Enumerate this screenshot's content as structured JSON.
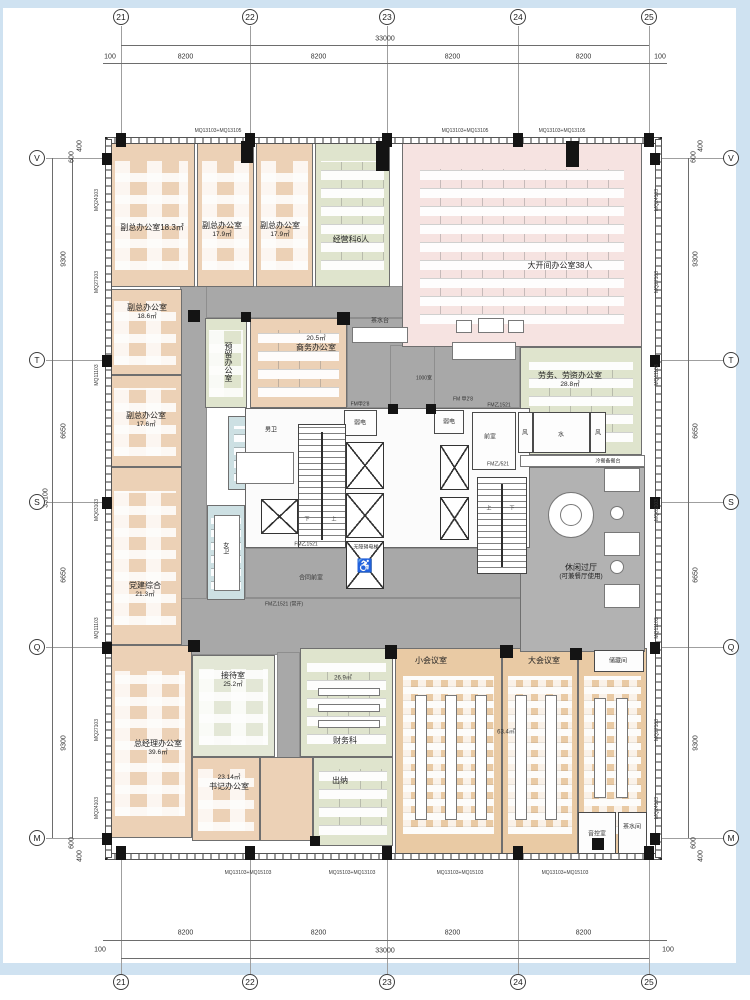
{
  "page": {
    "canvas_w": 750,
    "canvas_h": 1000
  },
  "frame": {
    "color": "#cfe2f1",
    "strips": [
      [
        0,
        0,
        750,
        8
      ],
      [
        0,
        963,
        750,
        12
      ],
      [
        736,
        8,
        14,
        955
      ],
      [
        0,
        8,
        3,
        955
      ]
    ]
  },
  "palette": {
    "peach": "#ecd1b6",
    "green": "#dfe4cd",
    "pink": "#f6e3e1",
    "tan": "#e9caa4",
    "grey": "#a8a8a8",
    "grey2": "#b2b2b2",
    "blue": "#cde0e3",
    "palegreen": "#e3e7d6",
    "wall": "#262626"
  },
  "building": {
    "x": 105,
    "y": 137,
    "w": 557,
    "h": 723
  },
  "grid": {
    "top": {
      "y_bubble": 17,
      "y_line_total": 45,
      "y_line_seg": 63,
      "total": "33000",
      "segments": [
        "8200",
        "8200",
        "8200",
        "8200"
      ],
      "offset_label": "100",
      "bubbles": [
        {
          "label": "21",
          "x": 121
        },
        {
          "label": "22",
          "x": 250
        },
        {
          "label": "23",
          "x": 387
        },
        {
          "label": "24",
          "x": 518
        },
        {
          "label": "25",
          "x": 649
        }
      ]
    },
    "bottom": {
      "y_bubble": 982,
      "y_line_total": 958,
      "y_line_seg": 940,
      "total": "33000",
      "segments": [
        "8200",
        "8200",
        "8200",
        "8200"
      ],
      "offset_label": "100"
    },
    "left": {
      "x_bubble": 37,
      "x_line_seg": 72,
      "x_line_total": 52,
      "total": "33100",
      "segments": [
        "9300",
        "6650",
        "6650",
        "9300"
      ],
      "bubbles": [
        {
          "label": "V",
          "y": 158
        },
        {
          "label": "T",
          "y": 360
        },
        {
          "label": "S",
          "y": 502
        },
        {
          "label": "Q",
          "y": 647
        },
        {
          "label": "M",
          "y": 838
        }
      ],
      "extras": [
        {
          "t": "400",
          "x": 80,
          "y": 146
        },
        {
          "t": "600",
          "x": 72,
          "y": 157
        },
        {
          "t": "600",
          "x": 72,
          "y": 843
        },
        {
          "t": "400",
          "x": 80,
          "y": 856
        }
      ]
    },
    "right": {
      "x_bubble": 731,
      "x_line_seg": 688,
      "segments": [
        "9300",
        "6650",
        "6650",
        "9300"
      ],
      "extras": [
        {
          "t": "400",
          "x": 701,
          "y": 146
        },
        {
          "t": "600",
          "x": 694,
          "y": 157
        },
        {
          "t": "600",
          "x": 694,
          "y": 843
        },
        {
          "t": "400",
          "x": 701,
          "y": 856
        }
      ]
    }
  },
  "wall_codes": {
    "left_x": 97,
    "right_x": 657,
    "side": [
      {
        "t": "MQ24103",
        "y": 200
      },
      {
        "t": "MQ27103",
        "y": 282
      },
      {
        "t": "MQ11103",
        "y": 375
      },
      {
        "t": "MQ63103",
        "y": 510
      },
      {
        "t": "MQ11103",
        "y": 628
      },
      {
        "t": "MQ27103",
        "y": 730
      },
      {
        "t": "MQ24103",
        "y": 808
      }
    ],
    "top": [
      {
        "t": "MQ13103+MQ13105",
        "x": 218
      },
      {
        "t": "MQ13103+MQ13105",
        "x": 465
      },
      {
        "t": "MQ13103+MQ13105",
        "x": 562
      }
    ],
    "bottom": [
      {
        "t": "MQ13103+MQ15103",
        "x": 248
      },
      {
        "t": "MQ15103+MQ13103",
        "x": 352
      },
      {
        "t": "MQ13103+MQ15103",
        "x": 460
      },
      {
        "t": "MQ13103+MQ15103",
        "x": 565
      }
    ]
  },
  "corridors": [
    [
      195,
      286,
      208,
      32
    ],
    [
      180,
      286,
      27,
      369
    ],
    [
      347,
      318,
      173,
      90
    ],
    [
      390,
      345,
      45,
      260
    ],
    [
      180,
      598,
      465,
      57
    ],
    [
      245,
      548,
      285,
      50
    ],
    [
      277,
      652,
      23,
      108
    ]
  ],
  "rooms": [
    {
      "id": "vice-office-a",
      "name": "副总办公室",
      "area": "18.3㎡",
      "x": 108,
      "y": 141,
      "w": 87,
      "h": 146,
      "fill": "peach",
      "pat": "office",
      "lx": 152,
      "ly": 228,
      "inline": true
    },
    {
      "id": "vice-office-b",
      "name": "副总办公室",
      "area": "17.9㎡",
      "x": 197,
      "y": 141,
      "w": 57,
      "h": 146,
      "fill": "peach",
      "pat": "office",
      "lx": 222,
      "ly": 230
    },
    {
      "id": "vice-office-c",
      "name": "副总办公室",
      "area": "17.9㎡",
      "x": 256,
      "y": 141,
      "w": 57,
      "h": 146,
      "fill": "peach",
      "pat": "office",
      "lx": 280,
      "ly": 230
    },
    {
      "id": "business-section",
      "name": "经营科6人",
      "x": 315,
      "y": 141,
      "w": 75,
      "h": 146,
      "fill": "green",
      "pat": "desks",
      "lx": 351,
      "ly": 240
    },
    {
      "id": "open-office",
      "name": "大开间办公室38人",
      "x": 402,
      "y": 141,
      "w": 240,
      "h": 206,
      "fill": "pink",
      "pat": "desks",
      "lx": 560,
      "ly": 266
    },
    {
      "id": "labor-office",
      "name": "劳务、劳资办公室",
      "area": "28.8㎡",
      "x": 520,
      "y": 347,
      "w": 122,
      "h": 108,
      "fill": "green",
      "pat": "desks",
      "lx": 570,
      "ly": 380
    },
    {
      "id": "vice-office-d",
      "name": "副总办公室",
      "area": "18.6㎡",
      "x": 108,
      "y": 289,
      "w": 74,
      "h": 86,
      "fill": "peach",
      "pat": "office",
      "lx": 147,
      "ly": 312
    },
    {
      "id": "vice-office-e",
      "name": "副总办公室",
      "area": "17.6㎡",
      "x": 108,
      "y": 375,
      "w": 74,
      "h": 92,
      "fill": "peach",
      "pat": "office",
      "lx": 146,
      "ly": 420
    },
    {
      "id": "party-office",
      "name": "党建综合",
      "area": "21.3㎡",
      "x": 108,
      "y": 467,
      "w": 74,
      "h": 178,
      "fill": "peach",
      "pat": "office",
      "lx": 145,
      "ly": 590
    },
    {
      "id": "gm-office",
      "name": "总经理办公室",
      "area": "39.6㎡",
      "x": 108,
      "y": 645,
      "w": 84,
      "h": 193,
      "fill": "peach",
      "pat": "office",
      "lx": 158,
      "ly": 748
    },
    {
      "id": "reception",
      "name": "接待室",
      "area": "25.2㎡",
      "x": 192,
      "y": 655,
      "w": 83,
      "h": 102,
      "fill": "palegreen",
      "pat": "office",
      "lx": 233,
      "ly": 680
    },
    {
      "id": "secretary-office",
      "name": "书记办公室",
      "area": "23.14㎡",
      "x": 192,
      "y": 757,
      "w": 68,
      "h": 84,
      "fill": "peach",
      "pat": "office",
      "lx": 229,
      "ly": 783,
      "area_first": true
    },
    {
      "id": "secretary-annex",
      "x": 260,
      "y": 757,
      "w": 53,
      "h": 84,
      "fill": "peach"
    },
    {
      "id": "reserved-office",
      "name": "预留办公室",
      "x": 205,
      "y": 318,
      "w": 42,
      "h": 90,
      "fill": "green",
      "pat": "office",
      "lx": 228,
      "ly": 362,
      "vert": true
    },
    {
      "id": "commerce-office",
      "name": "商务办公室",
      "area": "20.5㎡",
      "x": 250,
      "y": 318,
      "w": 97,
      "h": 90,
      "fill": "peach",
      "pat": "desks",
      "lx": 316,
      "ly": 344,
      "area_first": true
    },
    {
      "id": "finance-office",
      "name": "财务科",
      "x": 300,
      "y": 648,
      "w": 93,
      "h": 109,
      "fill": "green",
      "pat": "desks",
      "lx": 345,
      "ly": 741
    },
    {
      "id": "cashier",
      "name": "出纳",
      "x": 313,
      "y": 757,
      "w": 80,
      "h": 89,
      "fill": "green",
      "pat": "desks",
      "lx": 340,
      "ly": 781
    },
    {
      "id": "small-meeting",
      "name": "小会议室",
      "x": 395,
      "y": 648,
      "w": 107,
      "h": 210,
      "fill": "tan",
      "pat": "chairs",
      "lx": 431,
      "ly": 661
    },
    {
      "id": "large-meeting",
      "name": "大会议室",
      "x": 502,
      "y": 648,
      "w": 76,
      "h": 210,
      "fill": "tan",
      "pat": "chairs",
      "lx": 544,
      "ly": 661
    },
    {
      "id": "meeting-annex",
      "x": 578,
      "y": 648,
      "w": 69,
      "h": 210,
      "fill": "tan",
      "pat": "chairs"
    },
    {
      "id": "mens-wc",
      "name": "男卫",
      "x": 228,
      "y": 416,
      "w": 72,
      "h": 74,
      "fill": "blue",
      "pat": "wc",
      "lx": 271,
      "ly": 431,
      "small": true
    },
    {
      "id": "womens-wc",
      "name": "女卫",
      "x": 207,
      "y": 505,
      "w": 38,
      "h": 95,
      "fill": "blue",
      "pat": "wc",
      "lx": 224,
      "ly": 548,
      "vert": true,
      "small": true
    },
    {
      "id": "leisure-hall",
      "name": "休闲过厅",
      "sub": "(可兼餐厅使用)",
      "x": 520,
      "y": 467,
      "w": 125,
      "h": 185,
      "fill": "grey2",
      "lx": 581,
      "ly": 572
    }
  ],
  "core": {
    "base": [
      245,
      408,
      285,
      140
    ],
    "stairs": [
      [
        298,
        424,
        48,
        124
      ],
      [
        477,
        477,
        50,
        97
      ]
    ],
    "elevators": [
      [
        346,
        442,
        38,
        47
      ],
      [
        346,
        493,
        38,
        45
      ],
      [
        440,
        445,
        29,
        45
      ],
      [
        440,
        497,
        29,
        43
      ],
      [
        261,
        499,
        37,
        35
      ]
    ],
    "accessible_elevator": {
      "rect": [
        346,
        541,
        38,
        48
      ],
      "symbol": "♿"
    },
    "white_rooms": [
      {
        "r": [
          472,
          412,
          44,
          58
        ],
        "label": "前室",
        "lx": 490,
        "ly": 436
      },
      {
        "r": [
          344,
          410,
          33,
          26
        ],
        "label": "弱电",
        "lx": 360,
        "ly": 422
      },
      {
        "r": [
          434,
          410,
          30,
          24
        ],
        "label": "弱电",
        "lx": 449,
        "ly": 421
      },
      {
        "r": [
          533,
          412,
          57,
          41
        ],
        "label": "水",
        "lx": 561,
        "ly": 434
      },
      {
        "r": [
          518,
          412,
          15,
          41
        ],
        "label": "风",
        "lx": 525,
        "ly": 432
      },
      {
        "r": [
          590,
          412,
          16,
          41
        ],
        "label": "风",
        "lx": 598,
        "ly": 432
      },
      {
        "r": [
          594,
          650,
          50,
          22
        ],
        "label": "储藏间",
        "lx": 618,
        "ly": 660
      },
      {
        "r": [
          578,
          812,
          38,
          44
        ],
        "label": "音控室",
        "lx": 597,
        "ly": 833
      },
      {
        "r": [
          618,
          812,
          29,
          44
        ],
        "label": "茶水间",
        "lx": 632,
        "ly": 826
      }
    ]
  },
  "furniture": {
    "rects": [
      [
        352,
        327,
        56,
        16
      ],
      [
        452,
        342,
        64,
        18
      ],
      [
        456,
        320,
        16,
        13
      ],
      [
        478,
        318,
        26,
        15
      ],
      [
        508,
        320,
        16,
        13
      ],
      [
        604,
        468,
        36,
        24
      ],
      [
        604,
        532,
        36,
        24
      ],
      [
        604,
        584,
        36,
        24
      ],
      [
        594,
        698,
        12,
        100
      ],
      [
        616,
        698,
        12,
        100
      ],
      [
        520,
        455,
        125,
        12
      ],
      [
        236,
        452,
        58,
        32
      ],
      [
        214,
        515,
        26,
        76
      ],
      [
        415,
        695,
        12,
        125
      ],
      [
        445,
        695,
        12,
        125
      ],
      [
        475,
        695,
        12,
        125
      ],
      [
        515,
        695,
        12,
        125
      ],
      [
        545,
        695,
        12,
        125
      ],
      [
        318,
        688,
        62,
        8
      ],
      [
        318,
        704,
        62,
        8
      ],
      [
        318,
        720,
        62,
        8
      ]
    ],
    "circles": [
      [
        548,
        492,
        46
      ],
      [
        560,
        504,
        22
      ],
      [
        610,
        506,
        14
      ],
      [
        610,
        560,
        14
      ]
    ]
  },
  "windows": {
    "top": [
      107,
      137,
      553,
      7
    ],
    "bottom": [
      107,
      853,
      553,
      7
    ],
    "left": [
      105,
      139,
      7,
      719
    ],
    "right": [
      655,
      139,
      7,
      719
    ]
  },
  "columns": [
    [
      116,
      133,
      10,
      14
    ],
    [
      245,
      133,
      10,
      14
    ],
    [
      382,
      133,
      10,
      14
    ],
    [
      513,
      133,
      10,
      14
    ],
    [
      644,
      133,
      10,
      14
    ],
    [
      116,
      846,
      10,
      14
    ],
    [
      245,
      846,
      10,
      14
    ],
    [
      382,
      846,
      10,
      14
    ],
    [
      513,
      846,
      10,
      14
    ],
    [
      644,
      846,
      10,
      14
    ],
    [
      102,
      153,
      10,
      12
    ],
    [
      102,
      355,
      10,
      12
    ],
    [
      102,
      497,
      10,
      12
    ],
    [
      102,
      642,
      10,
      12
    ],
    [
      102,
      833,
      10,
      12
    ],
    [
      650,
      153,
      10,
      12
    ],
    [
      650,
      355,
      10,
      12
    ],
    [
      650,
      497,
      10,
      12
    ],
    [
      650,
      642,
      10,
      12
    ],
    [
      650,
      833,
      10,
      12
    ],
    [
      241,
      141,
      12,
      22
    ],
    [
      376,
      141,
      13,
      30
    ],
    [
      566,
      141,
      13,
      26
    ],
    [
      188,
      310,
      12,
      12
    ],
    [
      337,
      312,
      13,
      13
    ],
    [
      241,
      312,
      10,
      10
    ],
    [
      188,
      640,
      12,
      12
    ],
    [
      385,
      645,
      12,
      14
    ],
    [
      500,
      645,
      13,
      13
    ],
    [
      570,
      648,
      12,
      12
    ],
    [
      310,
      836,
      10,
      10
    ],
    [
      592,
      838,
      12,
      12
    ],
    [
      426,
      404,
      10,
      10
    ],
    [
      388,
      404,
      10,
      10
    ]
  ],
  "labels": [
    {
      "t": "茶水台",
      "x": 380,
      "y": 320,
      "s": 6
    },
    {
      "t": "1000宽",
      "x": 424,
      "y": 378,
      "s": 5
    },
    {
      "t": "冷餐备餐台",
      "x": 608,
      "y": 461,
      "s": 5
    },
    {
      "t": "合同前室",
      "x": 311,
      "y": 577,
      "s": 6
    },
    {
      "t": "无障碍电梯",
      "x": 366,
      "y": 547,
      "s": 5
    },
    {
      "t": "FM 甲2'8",
      "x": 463,
      "y": 399,
      "s": 5
    },
    {
      "t": "FM乙1521",
      "x": 499,
      "y": 405,
      "s": 5
    },
    {
      "t": "FM甲2'8",
      "x": 360,
      "y": 404,
      "s": 5
    },
    {
      "t": "FM乙/521",
      "x": 498,
      "y": 464,
      "s": 5
    },
    {
      "t": "FM乙1521",
      "x": 306,
      "y": 544,
      "s": 5
    },
    {
      "t": "FM乙1521 (常开)",
      "x": 284,
      "y": 604,
      "s": 5
    },
    {
      "t": "26.9㎡",
      "x": 343,
      "y": 677,
      "s": 6
    },
    {
      "t": "63.4㎡",
      "x": 506,
      "y": 731,
      "s": 6
    },
    {
      "t": "下",
      "x": 307,
      "y": 519,
      "s": 5
    },
    {
      "t": "上",
      "x": 334,
      "y": 519,
      "s": 5
    },
    {
      "t": "上",
      "x": 489,
      "y": 508,
      "s": 5
    },
    {
      "t": "下",
      "x": 512,
      "y": 508,
      "s": 5
    }
  ]
}
